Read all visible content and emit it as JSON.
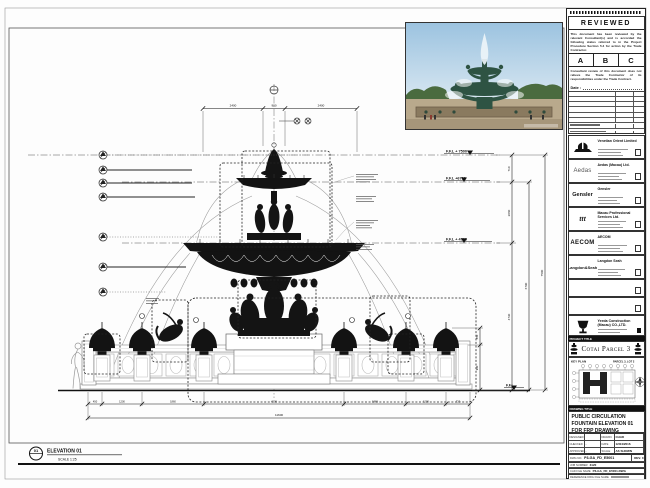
{
  "drawing": {
    "elevation_number": "01",
    "elevation_label": "ELEVATION 01",
    "elevation_scale": "SCALE 1:25",
    "levels": {
      "l7500": "F.F.L + 7500",
      "l6790": "F.F.L +6790",
      "l4730": "F.F.L + 4730",
      "ffl": "F.F.L."
    },
    "dims_top": [
      "2400",
      "900",
      "2400"
    ],
    "dims_right": [
      "710",
      "2060",
      "4730",
      "6790",
      "7500"
    ],
    "dims_pool": [
      "450",
      "930"
    ],
    "dims_bottom": [
      "450",
      "1200",
      "1860",
      "4200",
      "1860",
      "1200",
      "720"
    ],
    "dim_overall": "11600"
  },
  "stamp": {
    "title": "REVIEWED",
    "body1": "This document has been reviewed by the relevant Consultant(s) and is accorded the following status referred to in the Project Procedure Section 5.4 for action by the Trade Contractor.",
    "grades": [
      "A",
      "B",
      "C"
    ],
    "body2": "Consultant review of this document does not relieve the Trade Contractor of its responsibilities under the Trade Contract.",
    "date_label": "Date :"
  },
  "consultants": [
    {
      "logo": "",
      "name": "Venetian Orient Limited"
    },
    {
      "logo": "Aedas",
      "name": "Aedas (Macau) Ltd."
    },
    {
      "logo": "Gensler",
      "name": "Gensler"
    },
    {
      "logo": "ttt",
      "name": "Macau Professional Services Ltd."
    },
    {
      "logo": "AECOM",
      "name": "AECOM"
    },
    {
      "logo": "Langdon&Seah",
      "name": "Langdon Seah"
    }
  ],
  "contractor": {
    "name": "Yeeda Construction (Macau) CO.,LTD."
  },
  "project": {
    "bar": "PROJECT TITLE",
    "title": "Cotai Parcel 3"
  },
  "key_plan": {
    "label": "KEY PLAN",
    "sublabel": "PARCEL 3, LOT 2"
  },
  "title_block": {
    "bar": "DRAWING TITLE",
    "line1": "PUBLIC CIRCULATION",
    "line2": "FOUNTAIN ELEVATION 01",
    "line3": "FOR FRP DRAWING",
    "designed_label": "DESIGNED",
    "designed": "",
    "drawn_label": "DRAWN",
    "drawn": "CHAD",
    "checked_label": "CHECKED",
    "checked": "-",
    "date_label": "DATE",
    "date": "12/04/2016",
    "approved_label": "APPROVED",
    "approved": "-",
    "scale_label": "SCALE",
    "scale": "AS SHOWN",
    "dwg_label": "DWG NO.",
    "dwg_no": "P3-GA_FD_E5001",
    "rev": "REV. 0",
    "job_label": "JOB NUMBER",
    "job_no": "3120",
    "file_label": "CAD FILE NAME",
    "file_name": "P3-GA_FD_E5001.DWG",
    "ref_label": "REFERENCE DWG FILE NAME"
  }
}
